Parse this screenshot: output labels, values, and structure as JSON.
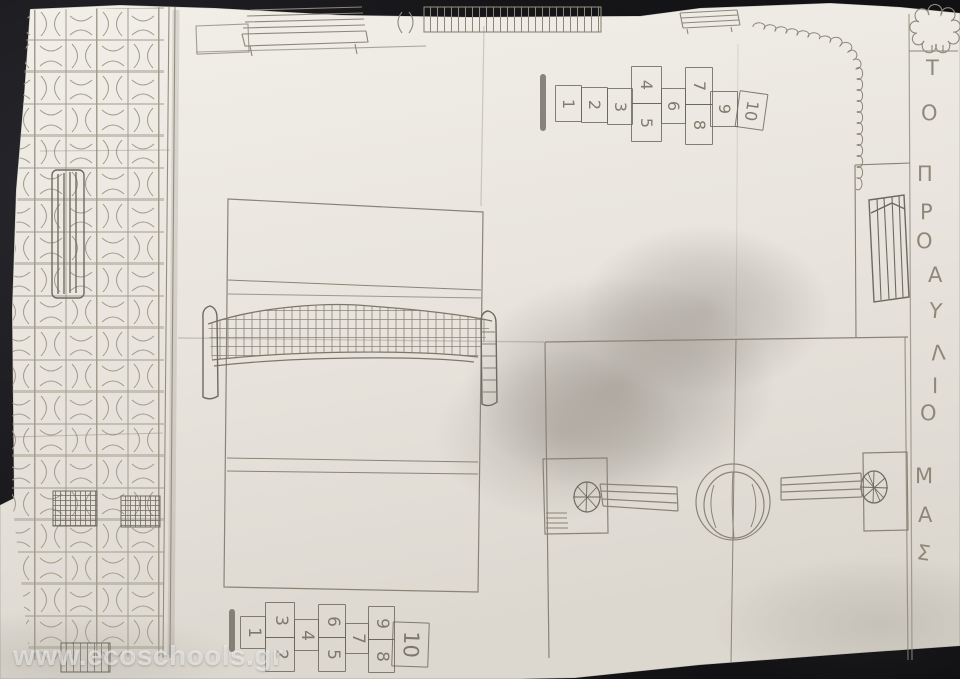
{
  "photo": {
    "background_color": "#17171a",
    "paper_color": "#e9e5de",
    "pencil_color": "#8d8779",
    "watermark_color": "rgba(255,255,255,0.55)"
  },
  "watermark": {
    "text": "www.ecoschools.gr"
  },
  "title": {
    "text": "ΤΟ ΠΡΟΑΥΛΙΟ ΜΑΣ",
    "orientation": "vertical, right margin, read top to bottom",
    "letters": [
      "Τ",
      "Ο",
      "Π",
      "Ρ",
      "Ο",
      "Α",
      "Υ",
      "Λ",
      "Ι",
      "Ο",
      "Μ",
      "Α",
      "Σ"
    ]
  },
  "hopscotch_top": {
    "numbers": [
      "1",
      "2",
      "3",
      "4",
      "5",
      "6",
      "7",
      "8",
      "9",
      "10"
    ]
  },
  "hopscotch_bottom": {
    "numbers": [
      "1",
      "2",
      "3",
      "4",
      "5",
      "6",
      "7",
      "8",
      "9",
      "10"
    ]
  },
  "figures": [
    "tiled-path",
    "striped-bench",
    "crosshatch-benches",
    "bench-top-left",
    "fence-grate",
    "bench-top-right",
    "spiral-garland-fence",
    "tree",
    "bench-right-margin",
    "volleyball-court-with-net-and-posts",
    "basketball-court-with-center-ball-and-hoops",
    "hopscotch-court-top",
    "hopscotch-court-bottom"
  ]
}
